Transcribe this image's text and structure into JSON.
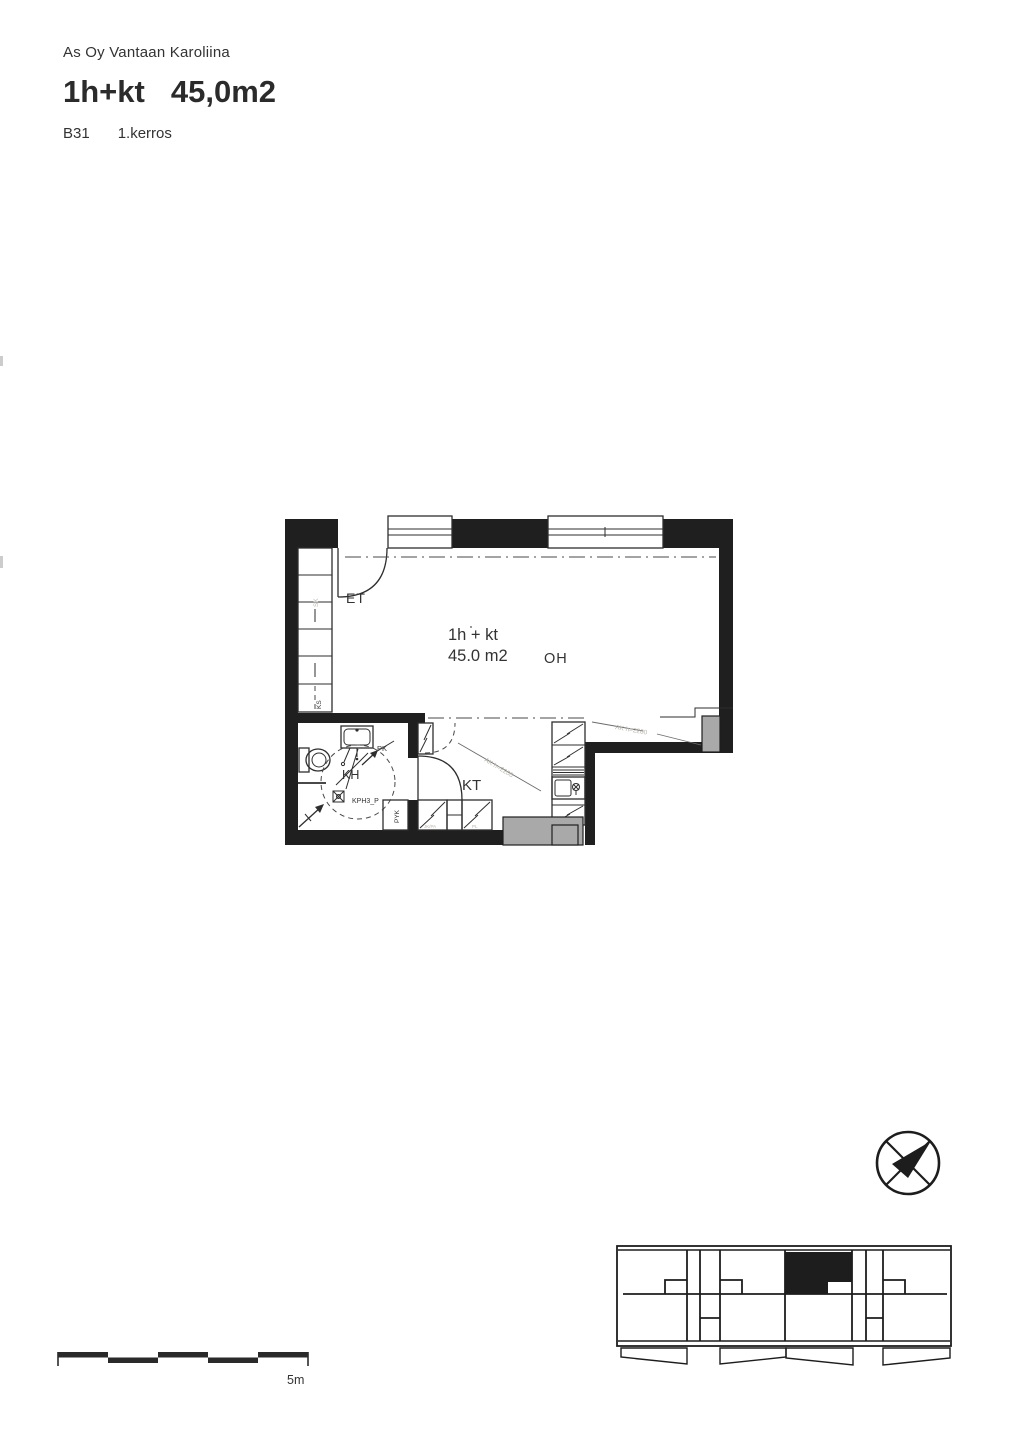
{
  "header": {
    "project": "As Oy Vantaan Karoliina",
    "type": "1h+kt",
    "area": "45,0m2",
    "unit": "B31",
    "floor": "1.kerros"
  },
  "plan": {
    "entry": "ET",
    "living": "OH",
    "kitchen": "KT",
    "bathroom": "KH",
    "type_label": "1h + kt",
    "area_label": "45.0 m2",
    "bathroom_code": "KPH3_P",
    "wardrobe_top": "SK",
    "wardrobe_bottom": "KS",
    "laundry_reservation": "PK",
    "linen_cabinet": "PYK",
    "ceiling_note": "AK h=2200",
    "appliance_a": "JK/PA",
    "appliance_b": "PL"
  },
  "scale_bar": {
    "label": "5m"
  },
  "colors": {
    "wall": "#1f1f1f",
    "line": "#2e2e2e",
    "gray": "#a9a9a9",
    "faint": "#b9b6ae",
    "text": "#333333",
    "paper": "#ffffff"
  }
}
